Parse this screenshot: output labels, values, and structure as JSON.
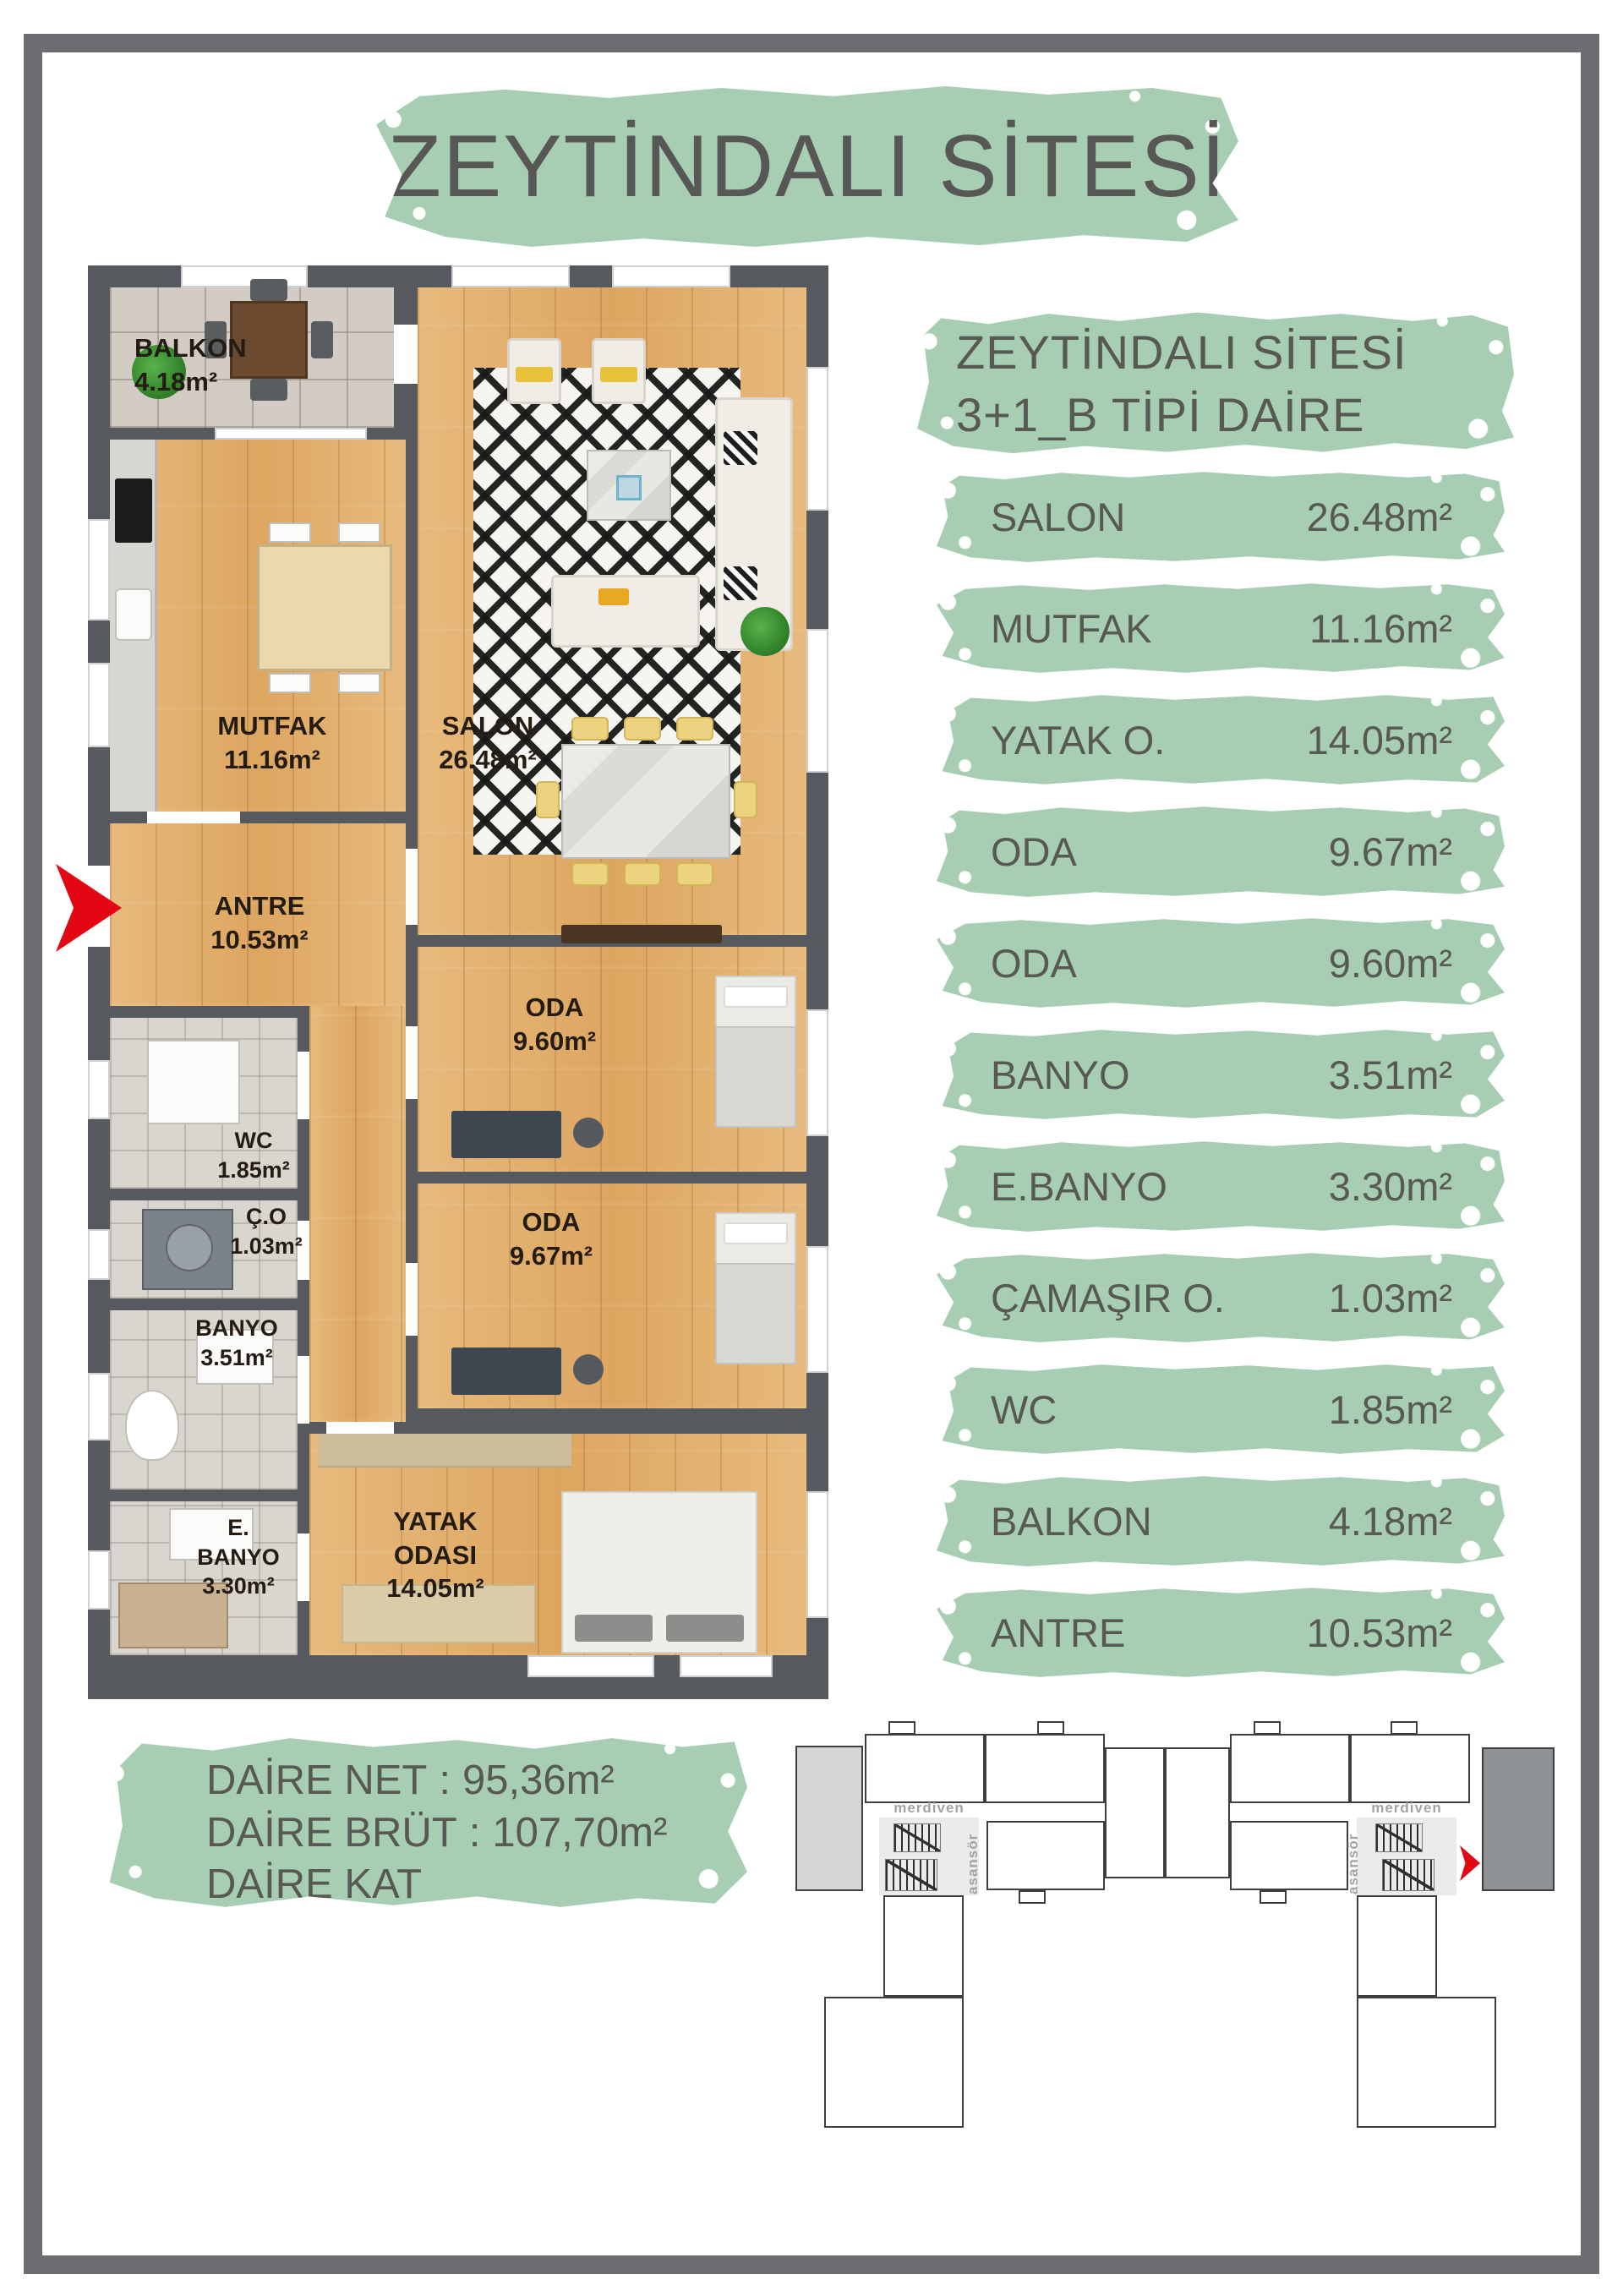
{
  "title": "ZEYTİNDALI SİTESİ",
  "colors": {
    "accent_green": "#a7ceb3",
    "text_dark": "#575756",
    "wall_gray": "#565a5f",
    "arrow_red": "#e30613",
    "wood": "#e2b173"
  },
  "plan": {
    "rooms": [
      {
        "name": "BALKON",
        "area": "4.18m²"
      },
      {
        "name": "MUTFAK",
        "area": "11.16m²"
      },
      {
        "name": "SALON",
        "area": "26.48m²"
      },
      {
        "name": "ANTRE",
        "area": "10.53m²"
      },
      {
        "name": "ODA",
        "area": "9.60m²"
      },
      {
        "name": "WC",
        "area": "1.85m²"
      },
      {
        "name": "Ç.O",
        "area": "1.03m²"
      },
      {
        "name": "BANYO",
        "area": "3.51m²"
      },
      {
        "name": "ODA",
        "area": "9.67m²"
      },
      {
        "name": "E.",
        "name2": "BANYO",
        "area": "3.30m²"
      },
      {
        "name": "YATAK",
        "name2": "ODASI",
        "area": "14.05m²"
      }
    ]
  },
  "legend": {
    "header_line1": "ZEYTİNDALI SİTESİ",
    "header_line2": "3+1_B TİPİ DAİRE PLANI",
    "rows": [
      {
        "label": "SALON",
        "value": "26.48m²"
      },
      {
        "label": "MUTFAK",
        "value": "11.16m²"
      },
      {
        "label": "YATAK O.",
        "value": "14.05m²"
      },
      {
        "label": "ODA",
        "value": "9.67m²"
      },
      {
        "label": "ODA",
        "value": "9.60m²"
      },
      {
        "label": "BANYO",
        "value": "3.51m²"
      },
      {
        "label": "E.BANYO",
        "value": "3.30m²"
      },
      {
        "label": "ÇAMAŞIR O.",
        "value": "1.03m²"
      },
      {
        "label": "WC",
        "value": "1.85m²"
      },
      {
        "label": "BALKON",
        "value": "4.18m²"
      },
      {
        "label": "ANTRE",
        "value": "10.53m²"
      }
    ]
  },
  "summary": {
    "separator": ":",
    "rows": [
      {
        "label": "DAİRE NET",
        "value": "95,36m²"
      },
      {
        "label": "DAİRE BRÜT",
        "value": "107,70m²"
      },
      {
        "label": "DAİRE KAT BRÜTÜ",
        "value": "173,20m²"
      }
    ]
  },
  "keyplan": {
    "left_core": {
      "stairs": "merdiven",
      "elevator": "asansör"
    },
    "right_core": {
      "stairs": "merdiven",
      "elevator": "asansör"
    }
  }
}
